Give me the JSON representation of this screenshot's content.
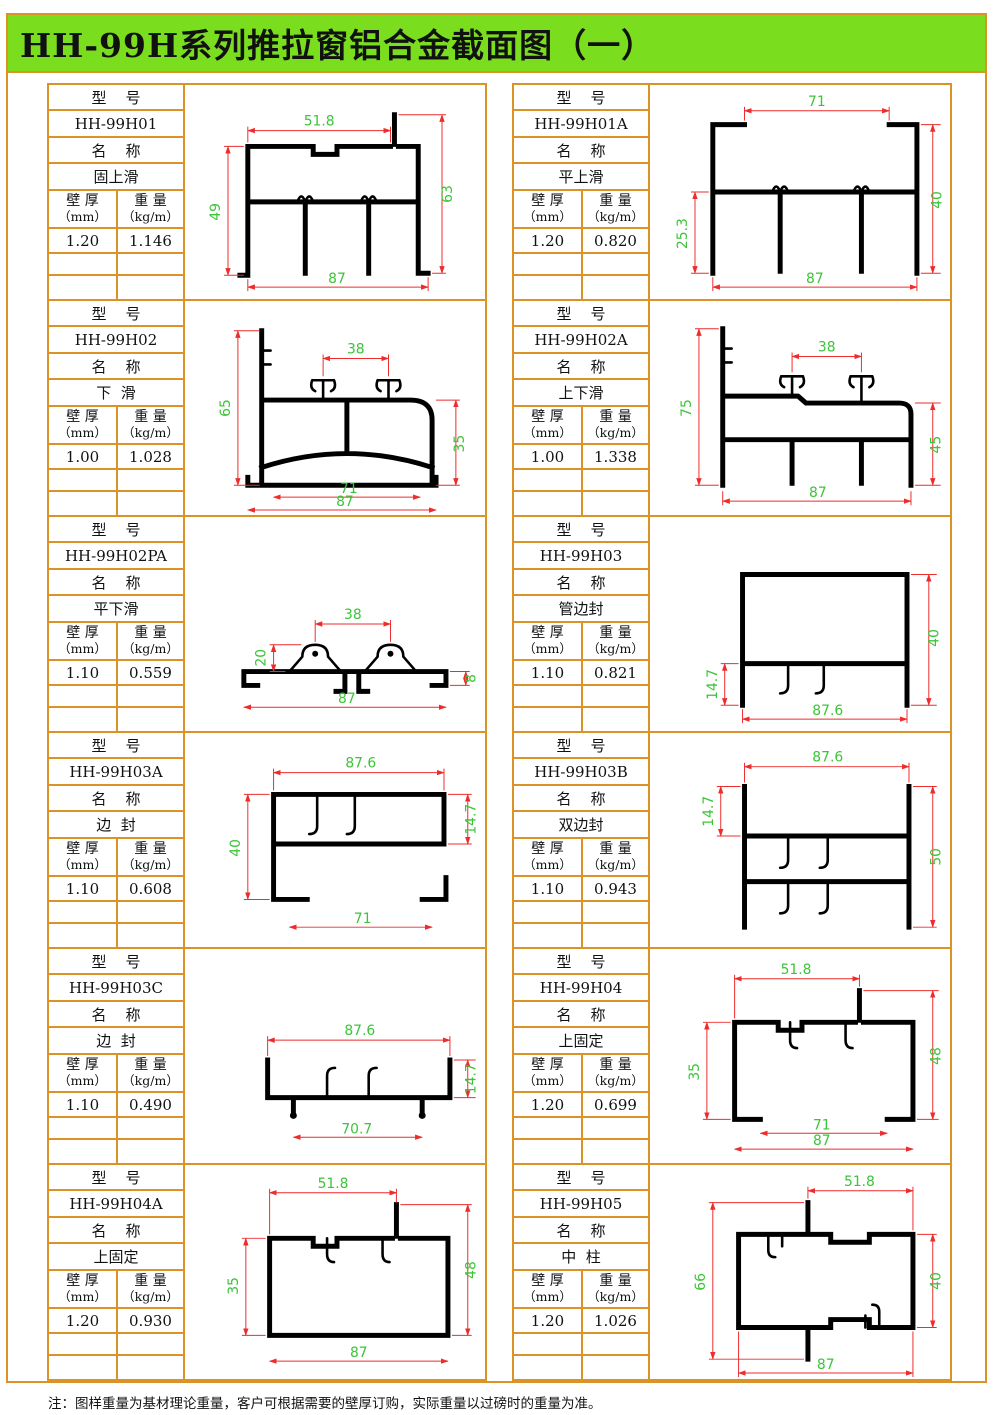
{
  "title": "HH-99H系列推拉窗铝合金截面图（一）",
  "footer_note": "注：图样重量为基材理论重量，客户可根据需要的壁厚订购，实际重量以过磅时的重量为准。",
  "labels": {
    "model_header": "型    号",
    "name_header": "名    称",
    "wall_label": "壁 厚",
    "wall_unit": "（mm）",
    "weight_label": "重 量",
    "weight_unit": "（kg/m）"
  },
  "colors": {
    "border_orange": "#db9227",
    "title_green": "#7ade1f",
    "dim_line_red": "#ee2c2c",
    "dim_text_green": "#3cc438",
    "profile_black": "#000000"
  },
  "cells": [
    {
      "model": "HH-99H01",
      "name": "固上滑",
      "wall_thickness": "1.20",
      "weight": "1.146",
      "dims": {
        "top": "51.8",
        "left": "49",
        "right": "63",
        "bottom": "87"
      }
    },
    {
      "model": "HH-99H01A",
      "name": "平上滑",
      "wall_thickness": "1.20",
      "weight": "0.820",
      "dims": {
        "top": "71",
        "left": "25.3",
        "right": "40",
        "bottom": "87"
      }
    },
    {
      "model": "HH-99H02",
      "name": "下  滑",
      "wall_thickness": "1.00",
      "weight": "1.028",
      "dims": {
        "top": "38",
        "left": "65",
        "right": "35",
        "bottom_inner": "71",
        "bottom": "87"
      }
    },
    {
      "model": "HH-99H02A",
      "name": "上下滑",
      "wall_thickness": "1.00",
      "weight": "1.338",
      "dims": {
        "top": "38",
        "left": "75",
        "right": "45",
        "bottom": "87"
      }
    },
    {
      "model": "HH-99H02PA",
      "name": "平下滑",
      "wall_thickness": "1.10",
      "weight": "0.559",
      "dims": {
        "top": "38",
        "left": "20",
        "right": "8",
        "bottom": "87"
      }
    },
    {
      "model": "HH-99H03",
      "name": "管边封",
      "wall_thickness": "1.10",
      "weight": "0.821",
      "dims": {
        "left": "14.7",
        "right": "40",
        "bottom": "87.6"
      }
    },
    {
      "model": "HH-99H03A",
      "name": "边  封",
      "wall_thickness": "1.10",
      "weight": "0.608",
      "dims": {
        "top": "87.6",
        "left": "40",
        "right": "14.7",
        "bottom": "71"
      }
    },
    {
      "model": "HH-99H03B",
      "name": "双边封",
      "wall_thickness": "1.10",
      "weight": "0.943",
      "dims": {
        "top": "87.6",
        "left": "14.7",
        "right": "50"
      }
    },
    {
      "model": "HH-99H03C",
      "name": "边  封",
      "wall_thickness": "1.10",
      "weight": "0.490",
      "dims": {
        "top": "87.6",
        "right": "14.7",
        "bottom": "70.7"
      }
    },
    {
      "model": "HH-99H04",
      "name": "上固定",
      "wall_thickness": "1.20",
      "weight": "0.699",
      "dims": {
        "top": "51.8",
        "left": "35",
        "right": "48",
        "bottom_inner": "71",
        "bottom": "87"
      }
    },
    {
      "model": "HH-99H04A",
      "name": "上固定",
      "wall_thickness": "1.20",
      "weight": "0.930",
      "dims": {
        "top": "51.8",
        "left": "35",
        "right": "48",
        "bottom": "87"
      }
    },
    {
      "model": "HH-99H05",
      "name": "中  柱",
      "wall_thickness": "1.20",
      "weight": "1.026",
      "dims": {
        "top": "51.8",
        "left": "66",
        "right": "40",
        "bottom": "87"
      }
    }
  ]
}
